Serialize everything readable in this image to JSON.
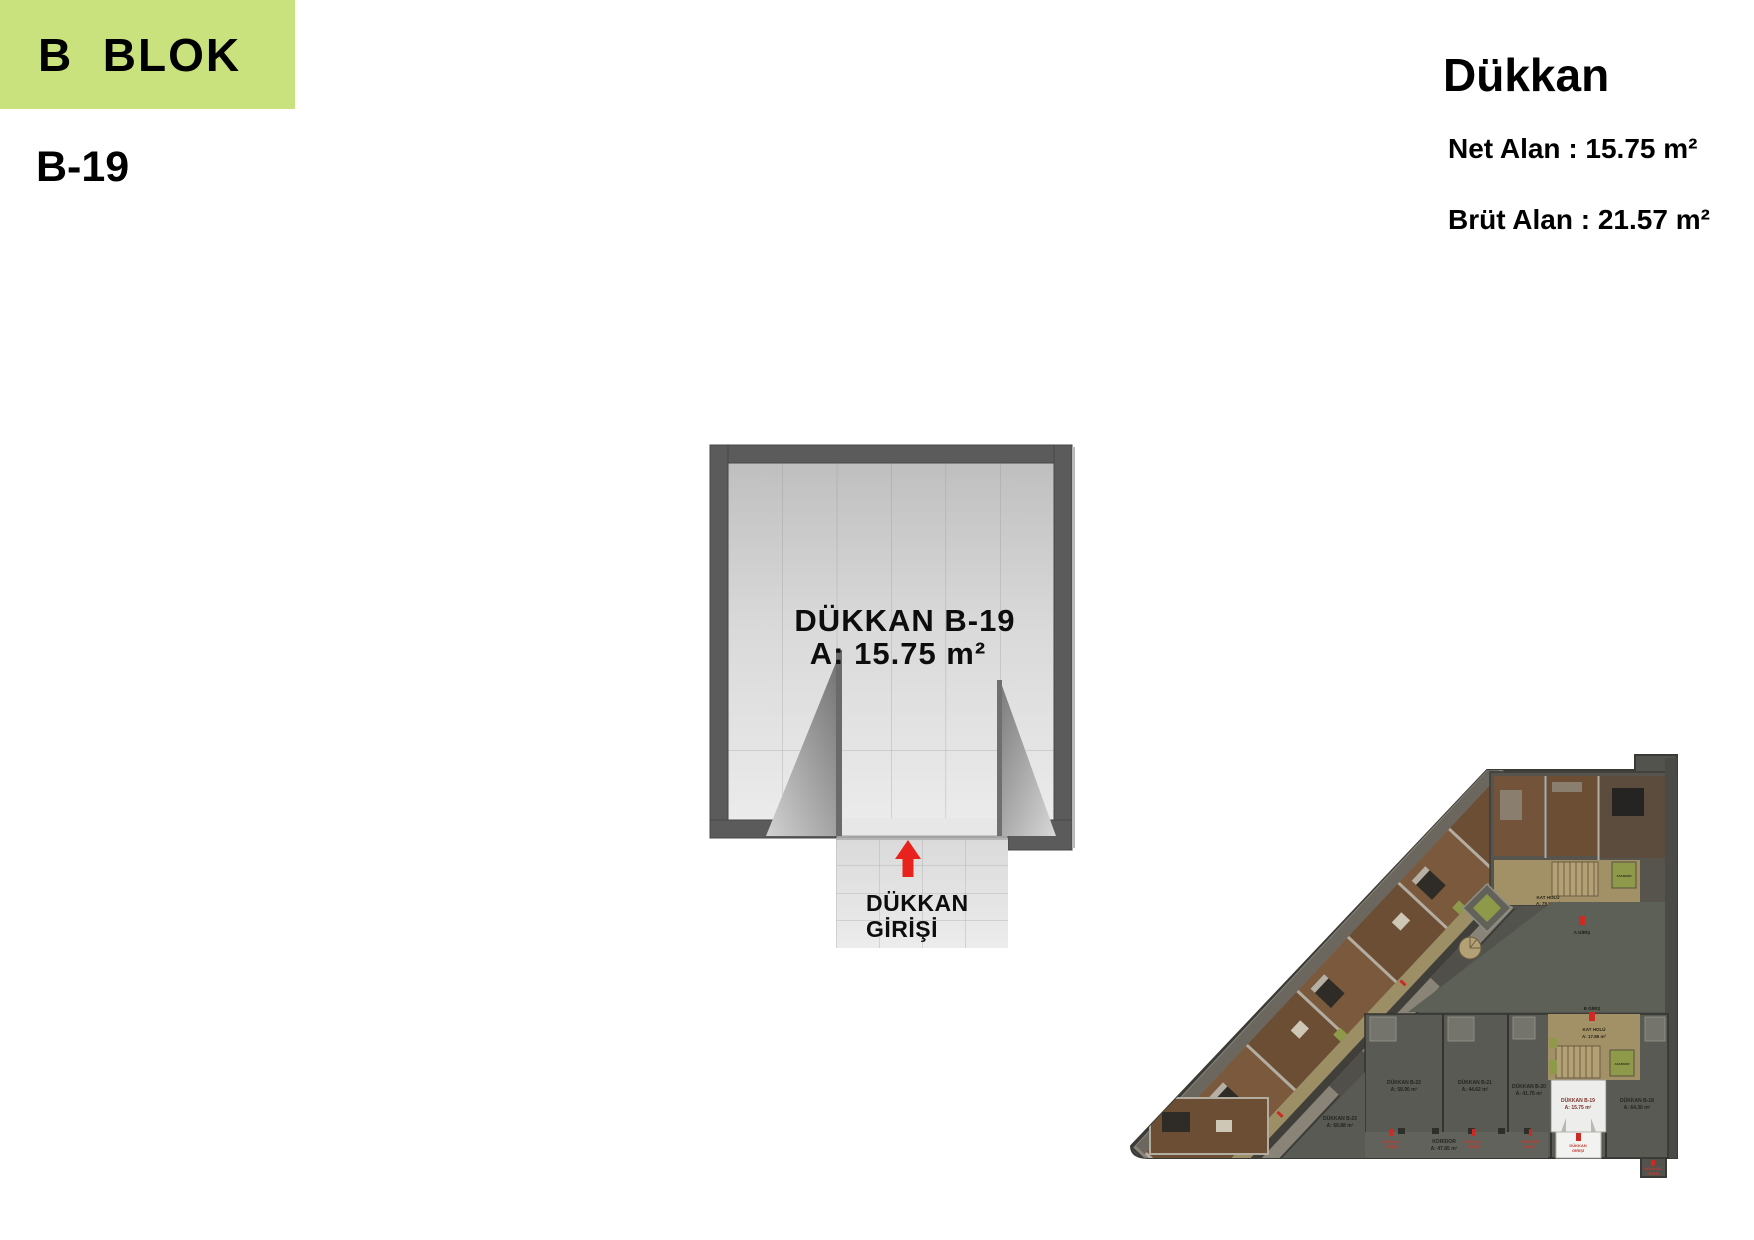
{
  "header": {
    "block_label": "B  BLOK",
    "unit_code": "B-19"
  },
  "unit_info": {
    "title": "Dükkan",
    "net_area_text": "Net Alan : 15.75 m²",
    "gross_area_text": "Brüt Alan : 21.57 m²",
    "net_area_value": "15.75 m²",
    "gross_area_value": "21.57 m²"
  },
  "floor_plan": {
    "room_name": "DÜKKAN B-19",
    "room_area": "A: 15.75 m²",
    "entrance_line1": "DÜKKAN",
    "entrance_line2": "GİRİŞİ"
  },
  "site_plan": {
    "shops": [
      {
        "id": "b23",
        "line1": "DÜKKAN B-23",
        "line2": "A: 66.88 m²"
      },
      {
        "id": "b22",
        "line1": "DÜKKAN B-22",
        "line2": "A: 58.90 m²"
      },
      {
        "id": "b21",
        "line1": "DÜKKAN B-21",
        "line2": "A: 44.62 m²"
      },
      {
        "id": "b20",
        "line1": "DÜKKAN B-20",
        "line2": "A: 41.75 m²"
      },
      {
        "id": "b19",
        "line1": "DÜKKAN B-19",
        "line2": "A: 15.75 m²"
      },
      {
        "id": "b18",
        "line1": "DÜKKAN B-18",
        "line2": "A: 64.30 m²"
      }
    ],
    "labels": {
      "kat_holu_a_line1": "KAT HOLÜ",
      "kat_holu_a_line2": "A: 79.50 m²",
      "kat_holu_b_line1": "KAT HOLÜ",
      "kat_holu_b_line2": "A: 17.85 m²",
      "koridor_line1": "KORİDOR",
      "koridor_line2": "A: 47.85 m²",
      "a_giris": "A GİRİŞ",
      "b_giris": "B GİRİŞ",
      "asansor": "ASANSÖR",
      "dukkan_girisi_line1": "DÜKKAN",
      "dukkan_girisi_line2": "GİRİŞİ"
    }
  },
  "colors": {
    "accent-green": "#c9e27e",
    "wall-gray": "#5b5b5b",
    "arrow-red": "#e8231d",
    "site-base": "#53534e",
    "site-courtyard": "#5c6056",
    "site-brown": "#6b4e34",
    "site-tan": "#a29066",
    "site-olive": "#8e9949",
    "highlight-white": "#ededeb"
  }
}
